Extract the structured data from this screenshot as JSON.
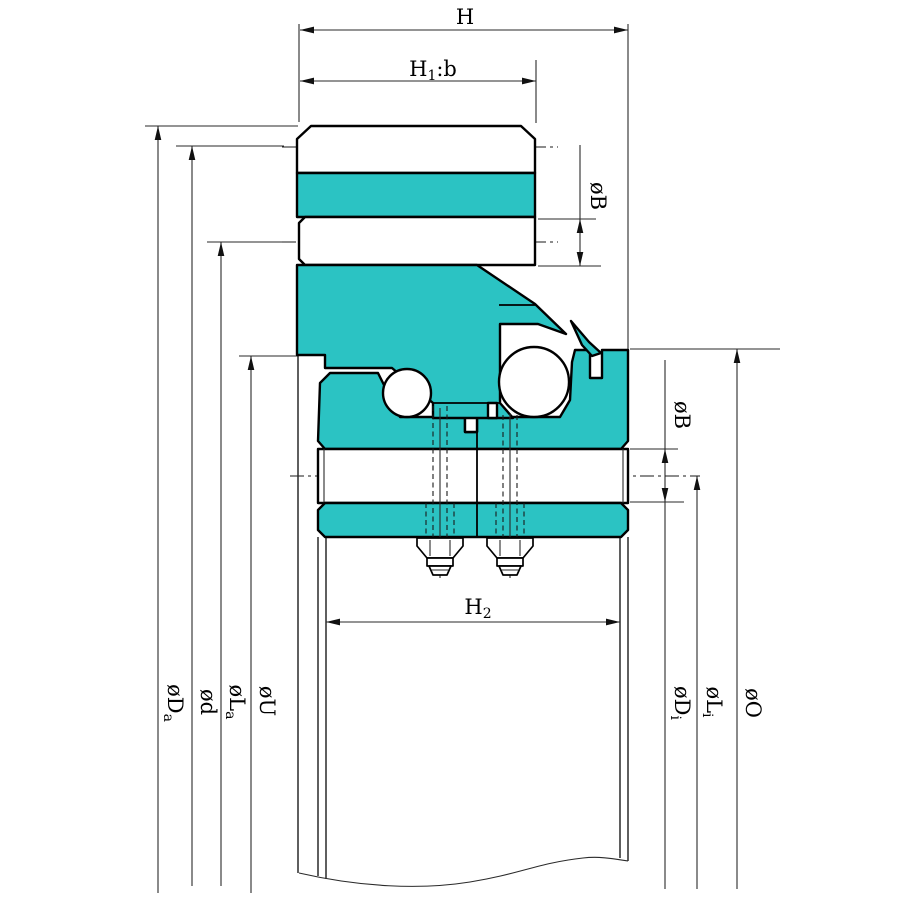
{
  "title": "Slewing bearing cross-section engineering drawing",
  "colors": {
    "teal": "#2BC3C3",
    "line": "#000000",
    "background": "#FFFFFF"
  },
  "dimensions": {
    "h": {
      "text": "H"
    },
    "h1b": {
      "main": "H",
      "sub": "1",
      "rest": ":b"
    },
    "h2": {
      "main": "H",
      "sub": "2"
    },
    "phi_b_top": {
      "text": "øB"
    },
    "phi_b_right": {
      "text": "øB"
    },
    "phi_da": {
      "main": "øD",
      "sub": "a"
    },
    "phi_d": {
      "text": "ød"
    },
    "phi_la": {
      "main": "øL",
      "sub": "a"
    },
    "phi_u": {
      "text": "øU"
    },
    "phi_di": {
      "main": "øD",
      "sub": "i"
    },
    "phi_li": {
      "main": "øL",
      "sub": "i"
    },
    "phi_o": {
      "text": "øO"
    }
  }
}
